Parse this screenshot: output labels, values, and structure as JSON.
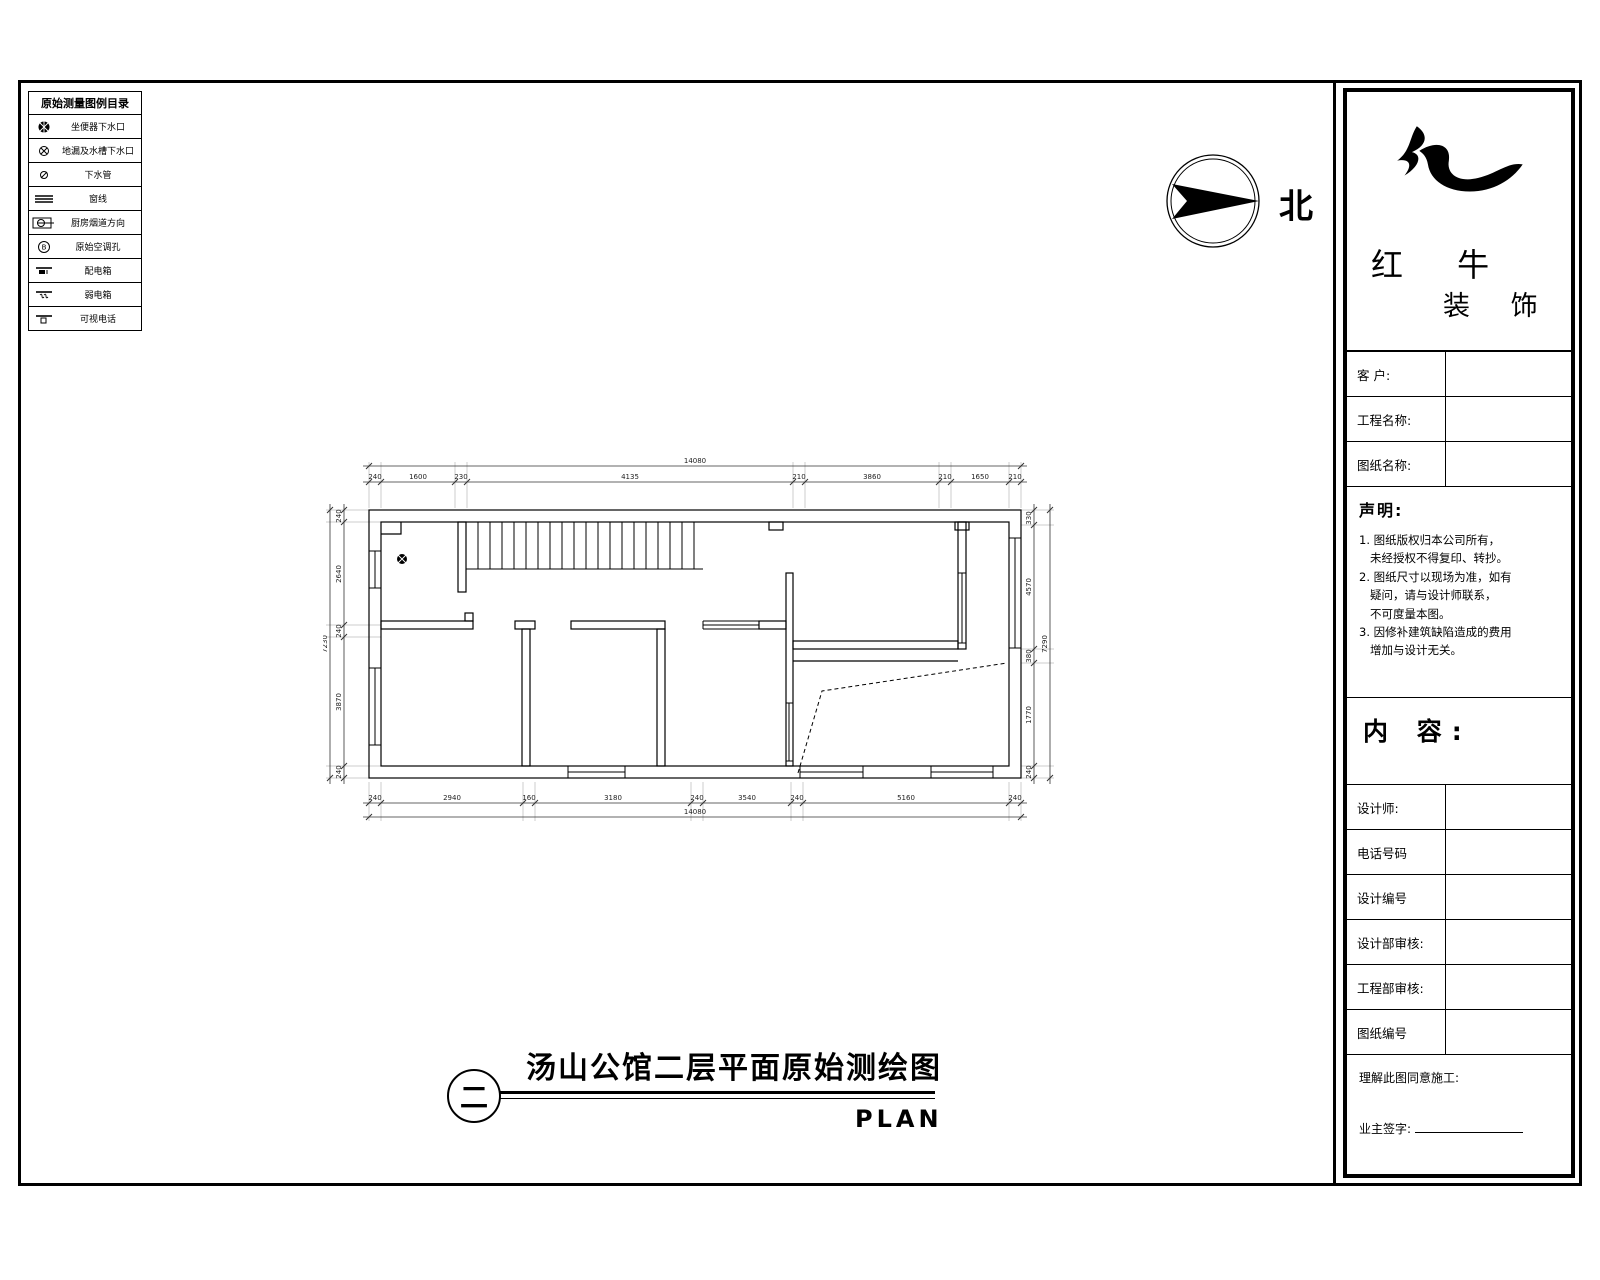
{
  "legend": {
    "title": "原始测量图例目录",
    "items": [
      {
        "icon": "toilet-drain-icon",
        "label": "坐便器下水口"
      },
      {
        "icon": "floor-drain-icon",
        "label": "地漏及水槽下水口"
      },
      {
        "icon": "drain-pipe-icon",
        "label": "下水管"
      },
      {
        "icon": "window-line-icon",
        "label": "窗线"
      },
      {
        "icon": "kitchen-flue-icon",
        "label": "厨房烟道方向"
      },
      {
        "icon": "ac-hole-icon",
        "label": "原始空调孔"
      },
      {
        "icon": "power-box-icon",
        "label": "配电箱"
      },
      {
        "icon": "weak-box-icon",
        "label": "弱电箱"
      },
      {
        "icon": "video-phone-icon",
        "label": "可视电话"
      }
    ]
  },
  "compass": {
    "label": "北"
  },
  "plan": {
    "dims": {
      "top": [
        "240",
        "1600",
        "230",
        "4135",
        "210",
        "3860",
        "210",
        "1650",
        "210"
      ],
      "top_total": "14080",
      "bottom": [
        "240",
        "2940",
        "160",
        "3180",
        "240",
        "3540",
        "240",
        "5160",
        "240"
      ],
      "bottom_total": "14080",
      "left": [
        "240",
        "2640",
        "240",
        "3870",
        "240"
      ],
      "left_total": "7230",
      "right": [
        "330",
        "4570",
        "380",
        "1770",
        "240"
      ],
      "right_total": "7290"
    }
  },
  "panel": {
    "logo": {
      "line1": "红 牛",
      "line2": "装 饰"
    },
    "fields": [
      {
        "label": "客  户:",
        "value": ""
      },
      {
        "label": "工程名称:",
        "value": ""
      },
      {
        "label": "图纸名称:",
        "value": ""
      }
    ],
    "statement": {
      "heading": "声明:",
      "lines": [
        "1. 图纸版权归本公司所有，",
        "   未经授权不得复印、转抄。",
        "2. 图纸尺寸以现场为准，如有",
        "   疑问，请与设计师联系，",
        "   不可度量本图。",
        "3. 因修补建筑缺陷造成的费用",
        "   增加与设计无关。"
      ]
    },
    "content_heading": "内 容:",
    "rows": [
      {
        "label": "设计师:",
        "value": ""
      },
      {
        "label": "电话号码",
        "value": ""
      },
      {
        "label": "设计编号",
        "value": ""
      },
      {
        "label": "设计部审核:",
        "value": ""
      },
      {
        "label": "工程部审核:",
        "value": ""
      },
      {
        "label": "图纸编号",
        "value": ""
      }
    ],
    "footer": {
      "line1": "理解此图同意施工:",
      "line2": "业主签字:"
    }
  },
  "footer": {
    "title": "汤山公馆二层平面原始测绘图",
    "plan_label": "PLAN",
    "sheet_symbol": "二"
  }
}
